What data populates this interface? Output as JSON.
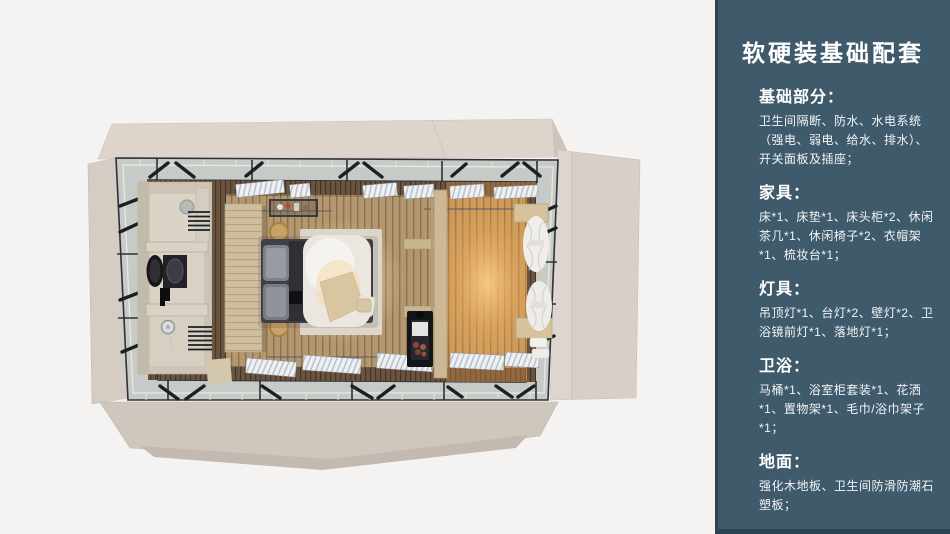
{
  "panel": {
    "title": "软硬装基础配套",
    "background_color": "#3E5A6B",
    "text_color": "#FFFFFF",
    "sections": [
      {
        "heading": "基础部分：",
        "body": "卫生间隔断、防水、水电系统（强电、弱电、给水、排水）、开关面板及插座；"
      },
      {
        "heading": "家具：",
        "body": "床*1、床垫*1、床头柜*2、休闲茶几*1、休闲椅子*2、衣帽架*1、梳妆台*1；"
      },
      {
        "heading": "灯具：",
        "body": "吊顶灯*1、台灯*2、壁灯*2、卫浴镜前灯*1、落地灯*1；"
      },
      {
        "heading": "卫浴：",
        "body": "马桶*1、浴室柜套装*1、花洒*1、置物架*1、毛巾/浴巾架子*1；"
      },
      {
        "heading": "地面：",
        "body": "强化木地板、卫生间防滑防潮石塑板；"
      }
    ]
  },
  "render_colors": {
    "background": "#F4F3F1",
    "deck_beige": "#D8CFC7",
    "walkway_gray": "#C7CBC7",
    "steel_dark": "#2C313A",
    "bedroom_floor": "#B39771",
    "lounge_floor_glow": "#E8A95F",
    "headboard_wood": "#CFBD9F",
    "duvet_white": "#EBE6DF"
  }
}
